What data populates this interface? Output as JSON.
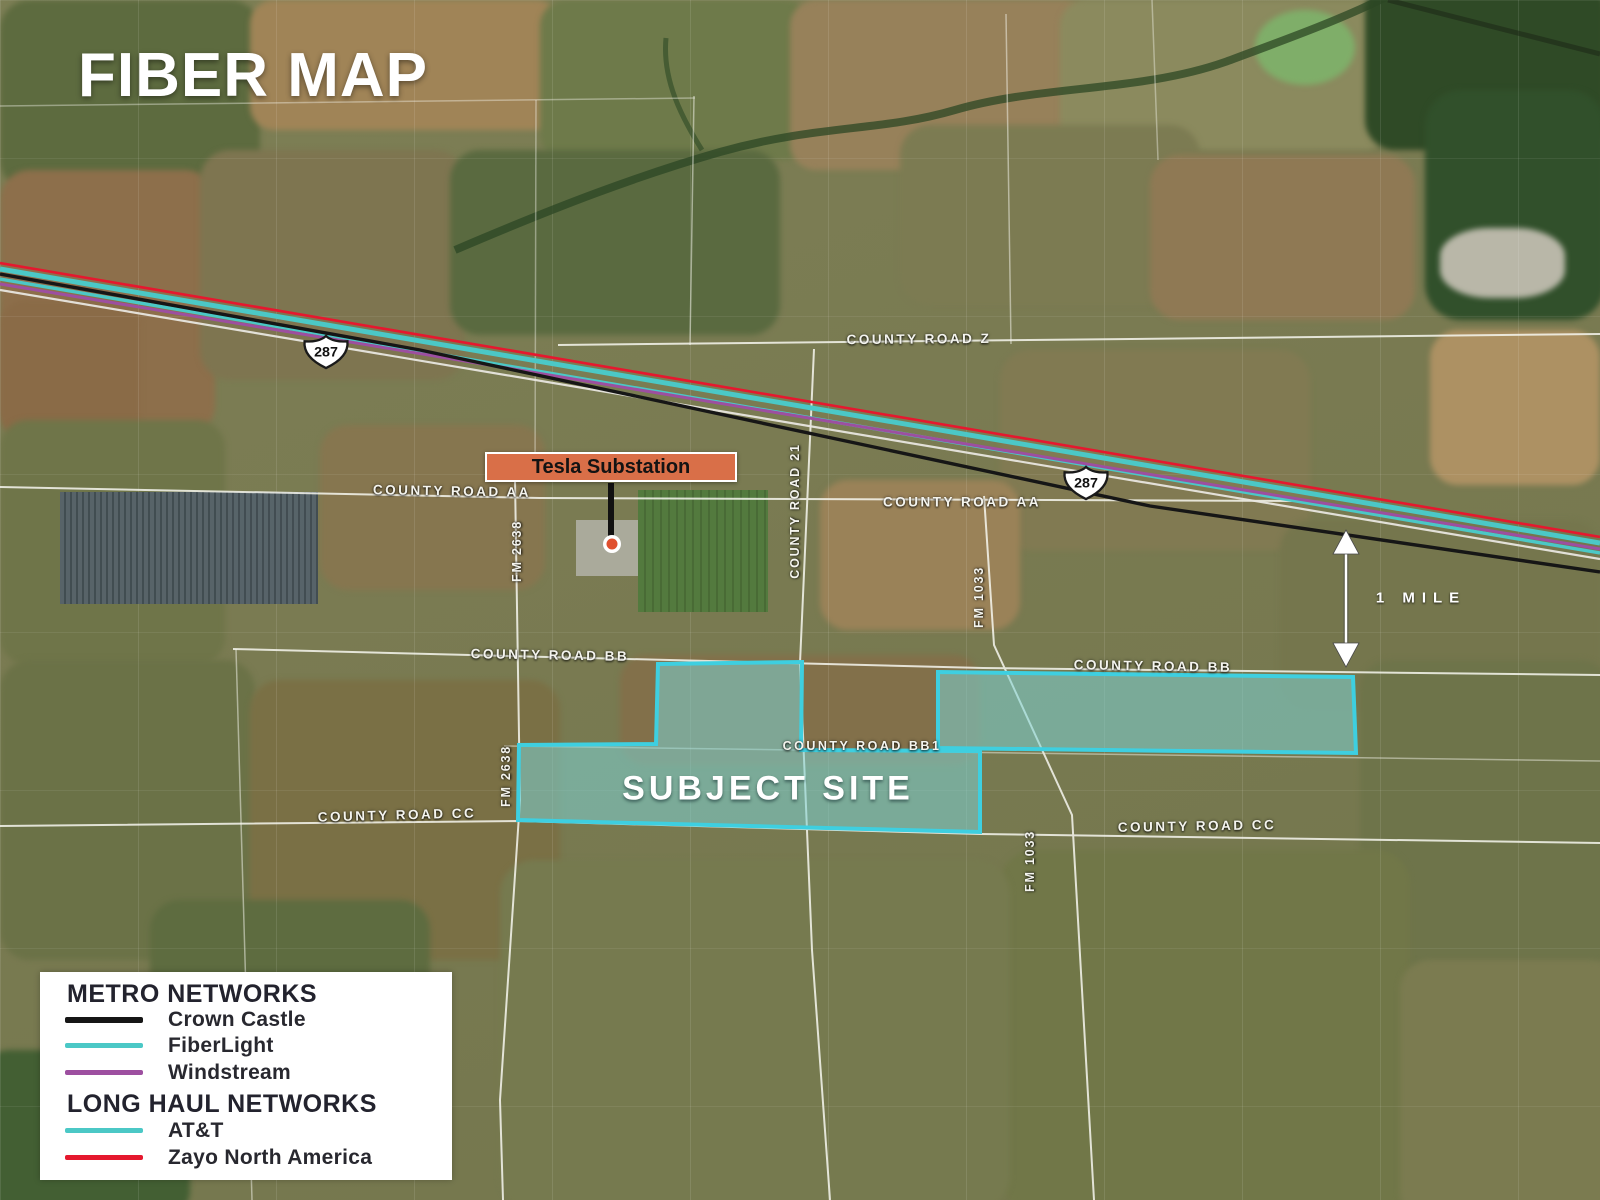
{
  "title": "FIBER MAP",
  "annotations": {
    "substation": "Tesla Substation",
    "subject_site": "SUBJECT SITE",
    "scale": "1 MILE"
  },
  "shields": [
    {
      "route": "287"
    },
    {
      "route": "287"
    }
  ],
  "roads": {
    "labels": [
      {
        "text": "COUNTY ROAD Z"
      },
      {
        "text": "COUNTY ROAD AA"
      },
      {
        "text": "COUNTY ROAD AA"
      },
      {
        "text": "COUNTY ROAD BB"
      },
      {
        "text": "COUNTY ROAD BB"
      },
      {
        "text": "COUNTY ROAD BB1"
      },
      {
        "text": "COUNTY ROAD CC"
      },
      {
        "text": "COUNTY ROAD CC"
      },
      {
        "text": "FM 2638"
      },
      {
        "text": "FM 2638"
      },
      {
        "text": "COUNTY ROAD 21"
      },
      {
        "text": "FM 1033"
      },
      {
        "text": "FM 1033"
      }
    ]
  },
  "legend": {
    "metro_header": "METRO NETWORKS",
    "long_haul_header": "LONG HAUL NETWORKS",
    "metro_items": [
      {
        "label": "Crown Castle",
        "color": "#161616"
      },
      {
        "label": "FiberLight",
        "color": "#4bc8c6"
      },
      {
        "label": "Windstream",
        "color": "#9d4fa0"
      }
    ],
    "long_haul_items": [
      {
        "label": "AT&T",
        "color": "#4bc8c6"
      },
      {
        "label": "Zayo North America",
        "color": "#e5182e"
      }
    ]
  },
  "colors": {
    "subject_site_fill": "#7ed3d3",
    "subject_site_border": "#3ecfe0",
    "substation_label_bg": "#d96f48",
    "substation_dot": "#e0502f"
  }
}
